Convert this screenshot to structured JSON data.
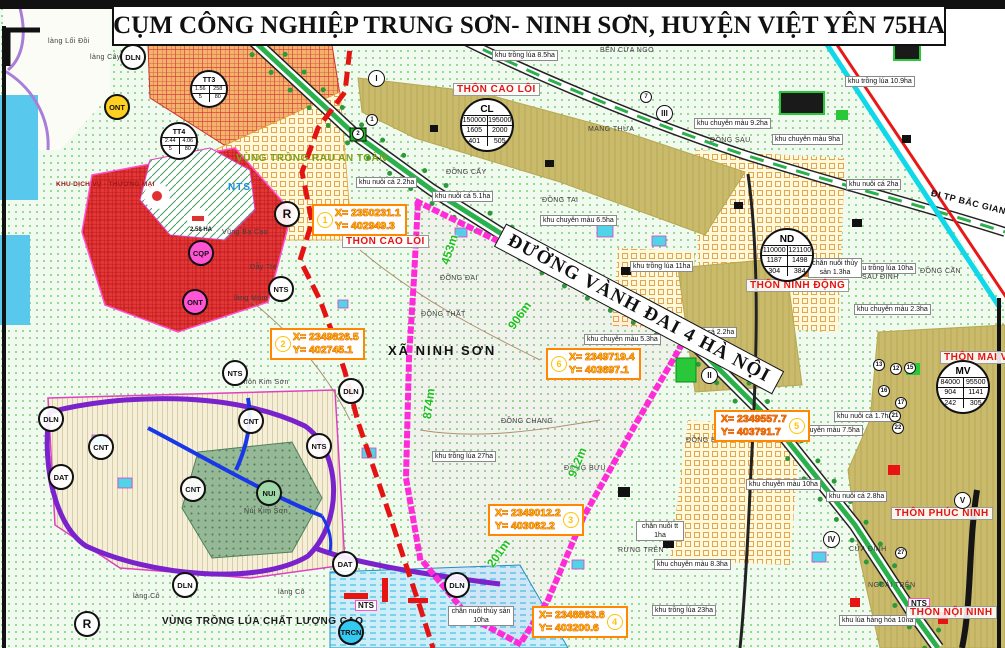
{
  "title": "CỤM CÔNG NGHIỆP TRUNG SƠN- NINH SƠN, HUYỆN VIỆT YÊN 75HA",
  "colors": {
    "cluster_boundary": "#ff2ad8",
    "planning_boundary_red": "#e41414",
    "road_green": "#2ab14c",
    "water": "#58c8ec",
    "village_text": "#e41414",
    "measure_text": "#1fc11f",
    "coord_text": "#ffe400"
  },
  "road": {
    "ring_road": "ĐƯỜNG VÀNH ĐAI 4 HÀ NỘI",
    "direction": "ĐI TP BẮC GIANG"
  },
  "regions": {
    "commune": "XÃ NINH SƠN",
    "veg_zone": "VÙNG TRỒNG RAU AN TOÀN",
    "rice_zone": "VÙNG TRỒNG LÚA CHẤT LƯỢNG CAO",
    "service_zone": "KHU DỊCH VỤ - THƯƠNG MẠI",
    "service_area": "2.58 HA"
  },
  "villages": [
    "THÔN CAO LÔI",
    "THÔN CAO LÔI",
    "THÔN NINH ĐỘNG",
    "THÔN MAI VŨ",
    "THÔN PHÚC NINH",
    "THÔN NỘI NINH"
  ],
  "plots": [
    "khu trồng lúa 8.5ha",
    "khu trồng lúa 10.9ha",
    "khu chuyên màu 9.2ha",
    "khu chuyên màu 9ha",
    "khu nuôi cá 2.2ha",
    "khu nuôi cá 5.1ha",
    "khu chuyên màu 6.5ha",
    "khu nuôi cá 2ha",
    "khu trồng lúa 11ha",
    "khu trồng lúa 10ha",
    "khu chuyên màu 2.3ha",
    "khu chuyên màu 5.3ha",
    "khu nuôi cá 2.2ha",
    "khu nuôi cá 1.7ha",
    "khu chuyên màu 7.5ha",
    "khu trồng lúa 27ha",
    "khu chuyên màu 10ha",
    "khu nuôi cá 2.8ha",
    "khu chuyên màu 8.3ha",
    "chăn nuôi tt 1ha",
    "khu trồng lúa 23ha",
    "chăn nuôi thủy sản 10ha",
    "khu lúa hàng hóa 10ha",
    "chăn nuôi thủy sản 1.3ha"
  ],
  "places": [
    "làng Lối Đồi",
    "làng Cây Số",
    "BẾN CỬA NGÒ",
    "MANG THỪA",
    "ĐỒNG SAU",
    "ĐỒNG CẤY",
    "ĐỒNG TAI",
    "ĐỒNG CẦN",
    "SAU ĐÌNH",
    "ĐỒNG ĐAI",
    "ĐỒNG THẤT",
    "Vũng Bạ Cạo",
    "Dẫy Trẹ",
    "làng Mỏm",
    "Thôn Kim Sơn",
    "Núi Kim Sơn",
    "ĐỒNG CHANG",
    "ĐỒNG BƯU",
    "ĐỒNG BẰNG",
    "RỪNG TRÊN",
    "CỬA ĐÌNH",
    "NGOÀI TRÊN",
    "làng Cô",
    "làng Cô"
  ],
  "coords": [
    {
      "n": "1",
      "x": "X= 2350231.1",
      "y": "Y= 402949.3"
    },
    {
      "n": "2",
      "x": "X= 2349826.5",
      "y": "Y= 402745.1"
    },
    {
      "n": "6",
      "x": "X= 2349719.4",
      "y": "Y= 403697.1"
    },
    {
      "n": "5",
      "x": "X= 2349557.7",
      "y": "Y= 403791.7"
    },
    {
      "n": "3",
      "x": "X= 2349012.2",
      "y": "Y= 403062.2"
    },
    {
      "n": "4",
      "x": "X= 2348863.8",
      "y": "Y= 403200.6"
    }
  ],
  "measurements": [
    "453m",
    "906m",
    "874m",
    "912m",
    "201m"
  ],
  "marks": [
    {
      "t": "DLN"
    },
    {
      "t": "ONT"
    },
    {
      "t": "CNT"
    },
    {
      "t": "CNT"
    },
    {
      "t": "CNT"
    },
    {
      "t": "DLN"
    },
    {
      "t": "DLN"
    },
    {
      "t": "DLN"
    },
    {
      "t": "DLN"
    },
    {
      "t": "ONT"
    },
    {
      "t": "NTS"
    },
    {
      "t": "NTS"
    },
    {
      "t": "NTS"
    },
    {
      "t": "CQP"
    },
    {
      "t": "NUI"
    },
    {
      "t": "DAT"
    },
    {
      "t": "DAT"
    },
    {
      "t": "TRCN"
    },
    {
      "t": "R"
    },
    {
      "t": "R"
    }
  ],
  "nts_texts": [
    "NTS",
    "NTS",
    "NTS"
  ],
  "romans": [
    "I",
    "II",
    "III",
    "IV",
    "V"
  ],
  "numbers": [
    "1",
    "2",
    "7",
    "12",
    "13",
    "15",
    "16",
    "17",
    "21",
    "22",
    "27"
  ],
  "stats": [
    {
      "code": "CL",
      "r1a": "150000",
      "r1b": "195000",
      "r2a": "1605",
      "r2b": "2000",
      "r3a": "401",
      "r3b": "505"
    },
    {
      "code": "ND",
      "r1a": "110000",
      "r1b": "121100",
      "r2a": "1187",
      "r2b": "1498",
      "r3a": "304",
      "r3b": "384"
    },
    {
      "code": "MV",
      "r1a": "84000",
      "r1b": "95500",
      "r2a": "904",
      "r2b": "1141",
      "r3a": "242",
      "r3b": "305"
    },
    {
      "code": "TT3",
      "r1a": "1.56",
      "r1b": "258",
      "r2a": "5",
      "r2b": "80"
    },
    {
      "code": "TT4",
      "r1a": "2.44",
      "r1b": "4.06",
      "r2a": "5",
      "r2b": "80"
    }
  ]
}
